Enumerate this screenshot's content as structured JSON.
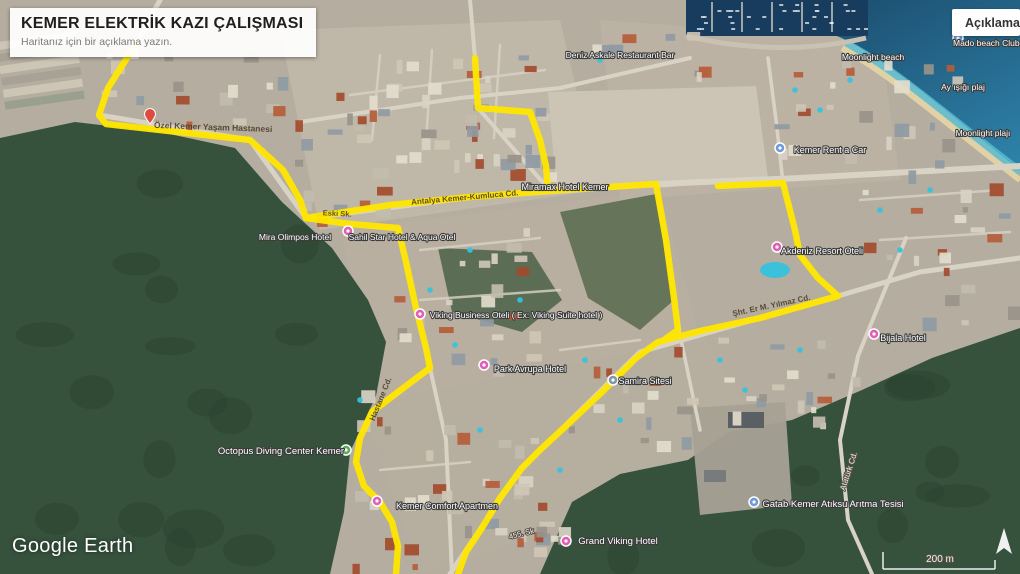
{
  "header": {
    "title": "KEMER ELEKTRİK KAZI ÇALIŞMASI",
    "subtitle": "Haritanız için bir açıklama yazın."
  },
  "toolbar": {
    "description_button": "Açıklama"
  },
  "map": {
    "attribution": "Google Earth",
    "scale_label": "200 m",
    "route_color": "#ffe600",
    "routes": [
      {
        "id": "nw-branch",
        "points": [
          [
            137,
            42
          ],
          [
            108,
            88
          ],
          [
            99,
            115
          ],
          [
            106,
            124
          ],
          [
            160,
            130
          ],
          [
            250,
            140
          ],
          [
            283,
            170
          ],
          [
            300,
            200
          ],
          [
            306,
            218
          ]
        ]
      },
      {
        "id": "main-road",
        "points": [
          [
            306,
            218
          ],
          [
            390,
            205
          ],
          [
            470,
            197
          ],
          [
            560,
            190
          ],
          [
            656,
            184
          ]
        ]
      },
      {
        "id": "center-branch",
        "points": [
          [
            306,
            218
          ],
          [
            350,
            224
          ],
          [
            398,
            228
          ],
          [
            406,
            262
          ],
          [
            416,
            308
          ],
          [
            426,
            348
          ],
          [
            430,
            368
          ]
        ]
      },
      {
        "id": "south-branch",
        "points": [
          [
            430,
            368
          ],
          [
            398,
            392
          ],
          [
            372,
            412
          ],
          [
            360,
            438
          ],
          [
            356,
            462
          ],
          [
            364,
            486
          ],
          [
            380,
            502
          ],
          [
            392,
            522
          ],
          [
            398,
            546
          ],
          [
            396,
            574
          ]
        ]
      },
      {
        "id": "top-branch",
        "points": [
          [
            475,
            58
          ],
          [
            478,
            108
          ],
          [
            530,
            112
          ],
          [
            540,
            140
          ],
          [
            546,
            166
          ],
          [
            548,
            189
          ]
        ]
      },
      {
        "id": "ne-top",
        "points": [
          [
            718,
            186
          ],
          [
            783,
            183
          ]
        ]
      },
      {
        "id": "ne-vertical",
        "points": [
          [
            783,
            183
          ],
          [
            795,
            230
          ],
          [
            800,
            255
          ],
          [
            818,
            278
          ],
          [
            838,
            296
          ]
        ]
      },
      {
        "id": "se-diagonal",
        "points": [
          [
            838,
            296
          ],
          [
            760,
            318
          ],
          [
            700,
            331
          ],
          [
            658,
            342
          ],
          [
            636,
            358
          ],
          [
            602,
            392
          ],
          [
            566,
            426
          ],
          [
            540,
            450
          ],
          [
            522,
            468
          ],
          [
            500,
            498
          ],
          [
            482,
            528
          ],
          [
            466,
            552
          ],
          [
            458,
            574
          ]
        ]
      },
      {
        "id": "east-connector",
        "points": [
          [
            656,
            184
          ],
          [
            666,
            240
          ],
          [
            674,
            298
          ],
          [
            678,
            330
          ],
          [
            664,
            340
          ]
        ]
      }
    ],
    "labels": [
      {
        "text": "Özel Kemer Yaşam Hastanesi",
        "x": 213,
        "y": 130,
        "rot": 2,
        "size": 8.5,
        "kind": "street"
      },
      {
        "text": "Antalya Kemer-Kumluca Cd.",
        "x": 465,
        "y": 200,
        "rot": -5,
        "size": 8,
        "kind": "street"
      },
      {
        "text": "Şht. Er M. Yılmaz Cd.",
        "x": 772,
        "y": 308,
        "rot": -12,
        "size": 8,
        "kind": "street"
      },
      {
        "text": "Hastane Cd.",
        "x": 383,
        "y": 400,
        "rot": -68,
        "size": 8,
        "kind": "street"
      },
      {
        "text": "Eski Sk.",
        "x": 337,
        "y": 216,
        "rot": 3,
        "size": 7.5,
        "kind": "street"
      },
      {
        "text": "Atatürk Cd.",
        "x": 851,
        "y": 472,
        "rot": -72,
        "size": 8,
        "kind": "road"
      },
      {
        "text": "455. Sk",
        "x": 522,
        "y": 536,
        "rot": -14,
        "size": 7.5,
        "kind": "road"
      },
      {
        "text": "Mira Olimpos Hotel",
        "x": 295,
        "y": 240,
        "size": 8.5,
        "kind": "poi"
      },
      {
        "text": "Sahil Star Hotel & Aqua Otel",
        "x": 402,
        "y": 240,
        "size": 8.5,
        "kind": "poi"
      },
      {
        "text": "Miramax Hotel Kemer",
        "x": 565,
        "y": 190,
        "size": 9,
        "kind": "poi"
      },
      {
        "text": "Viking Business Oteli ( Ex: Viking Suite hotel )",
        "x": 516,
        "y": 318,
        "size": 8.5,
        "kind": "poi"
      },
      {
        "text": "Park Avrupa Hotel",
        "x": 530,
        "y": 372,
        "size": 9,
        "kind": "poi"
      },
      {
        "text": "Samira Sitesi",
        "x": 645,
        "y": 384,
        "size": 9,
        "kind": "poi"
      },
      {
        "text": "Octopus Diving Center Kemer",
        "x": 281,
        "y": 454,
        "size": 9.5,
        "kind": "poi"
      },
      {
        "text": "Kemer Comfort Apartmen",
        "x": 447,
        "y": 509,
        "size": 9,
        "kind": "poi"
      },
      {
        "text": "Grand Viking Hotel",
        "x": 618,
        "y": 544,
        "size": 9.5,
        "kind": "poi"
      },
      {
        "text": "Gatab Kemer Atıksu Arıtma Tesisi",
        "x": 833,
        "y": 507,
        "size": 9.5,
        "kind": "poi"
      },
      {
        "text": "Bijala Hotel",
        "x": 903,
        "y": 341,
        "size": 9,
        "kind": "poi"
      },
      {
        "text": "Akdeniz Resort Oteli",
        "x": 822,
        "y": 254,
        "size": 9,
        "kind": "poi"
      },
      {
        "text": "Kemer Rent a Car",
        "x": 830,
        "y": 153,
        "size": 9,
        "kind": "poi"
      },
      {
        "text": "Deniz Askale Restaurant Bar",
        "x": 620,
        "y": 58,
        "size": 8.5,
        "kind": "poi"
      },
      {
        "text": "Mado beach Club Kemer",
        "x": 1000,
        "y": 46,
        "size": 8.5,
        "kind": "poi"
      },
      {
        "text": "Moonlight beach",
        "x": 873,
        "y": 60,
        "size": 8.5,
        "kind": "poi"
      },
      {
        "text": "Ay ışığı plaj",
        "x": 963,
        "y": 90,
        "size": 8.5,
        "kind": "poi"
      },
      {
        "text": "Moonlight plajı",
        "x": 983,
        "y": 136,
        "size": 8.5,
        "kind": "poi"
      }
    ],
    "markers": [
      {
        "name": "hospital",
        "shape": "pin",
        "color": "#e04b3f",
        "x": 150,
        "y": 124
      },
      {
        "name": "sahil-star-hotel",
        "shape": "dot",
        "color": "#e05fb8",
        "x": 348,
        "y": 231
      },
      {
        "name": "viking-business-hotel",
        "shape": "dot",
        "color": "#e05fb8",
        "x": 420,
        "y": 314
      },
      {
        "name": "park-avrupa-hotel",
        "shape": "dot",
        "color": "#e05fb8",
        "x": 484,
        "y": 365
      },
      {
        "name": "akdeniz-resort",
        "shape": "dot",
        "color": "#e05fb8",
        "x": 777,
        "y": 247
      },
      {
        "name": "bijala-hotel",
        "shape": "dot",
        "color": "#e05fb8",
        "x": 874,
        "y": 334
      },
      {
        "name": "kemer-comfort",
        "shape": "dot",
        "color": "#e05fb8",
        "x": 377,
        "y": 501
      },
      {
        "name": "grand-viking-hotel",
        "shape": "dot",
        "color": "#e05fb8",
        "x": 566,
        "y": 541
      },
      {
        "name": "kemer-rent-a-car",
        "shape": "dot",
        "color": "#6f9bd8",
        "x": 780,
        "y": 148
      },
      {
        "name": "beach-club",
        "shape": "dot",
        "color": "#6f9bd8",
        "x": 958,
        "y": 38
      },
      {
        "name": "gatab-aritma-tesisi",
        "shape": "dot",
        "color": "#6f9bd8",
        "x": 754,
        "y": 502
      },
      {
        "name": "samira-sitesi",
        "shape": "dot",
        "color": "#8296a8",
        "x": 613,
        "y": 380
      },
      {
        "name": "octopus-diving-center",
        "shape": "dot",
        "color": "#53b157",
        "x": 346,
        "y": 450
      }
    ]
  }
}
